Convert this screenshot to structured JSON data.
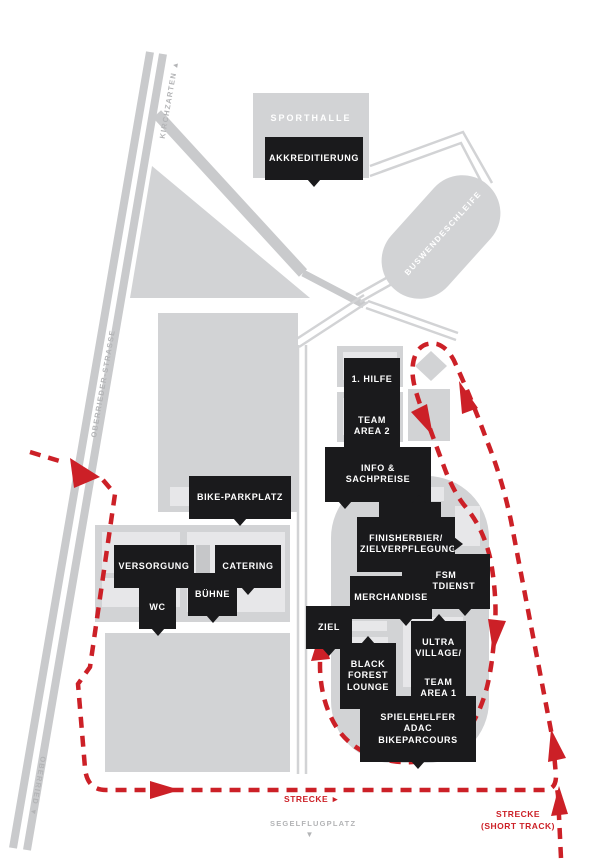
{
  "roads": {
    "kirchzarten": "KIRCHZARTEN ▲",
    "oberrieder_strasse": "OBERRIEDER-STRASSE",
    "oberried": "OBERRIED ▼"
  },
  "areas": {
    "sporthalle": "SPORTHALLE",
    "buswendeschleife": "BUSWENDESCHLEIFE",
    "segelflugplatz": "SEGELFLUGPLATZ",
    "segelflugplatz_arrow": "▼"
  },
  "labels": {
    "akkreditierung": "AKKREDITIERUNG",
    "erste_hilfe": "1. HILFE",
    "team_area_2": "TEAM\nAREA 2",
    "info_sachpreise": "INFO & SACHPREISE",
    "bike_parkplatz": "BIKE-PARKPLATZ",
    "leinwand": "LEINWAND",
    "finisherbier": "FINISHERBIER/\nZIELVERPFLEGUNG",
    "fsm_zeitdienst": "FSM ZEITDIENST",
    "merchandise": "MERCHANDISE",
    "versorgung": "VERSORGUNG",
    "catering": "CATERING",
    "buehne": "BÜHNE",
    "wc": "WC",
    "ziel": "ZIEL",
    "black_forest_lounge": "BLACK\nFOREST\nLOUNGE",
    "ultra_village_expo": "ULTRA\nVILLAGE/\nEXPO",
    "team_area_1": "TEAM\nAREA 1",
    "spielehelfer": "SPIELEHELFER\nADAC BIKEPARCOURS"
  },
  "route": {
    "strecke": "STRECKE ►",
    "strecke_short_track": "STRECKE\n(SHORT TRACK)"
  },
  "colors": {
    "building_gray": "#d2d3d5",
    "inner_light_gray": "#e7e7e9",
    "road_gray": "#c9cacc",
    "label_black": "#1a1a1c",
    "route_red": "#cc2027",
    "muted_text": "#b3b4b6"
  }
}
